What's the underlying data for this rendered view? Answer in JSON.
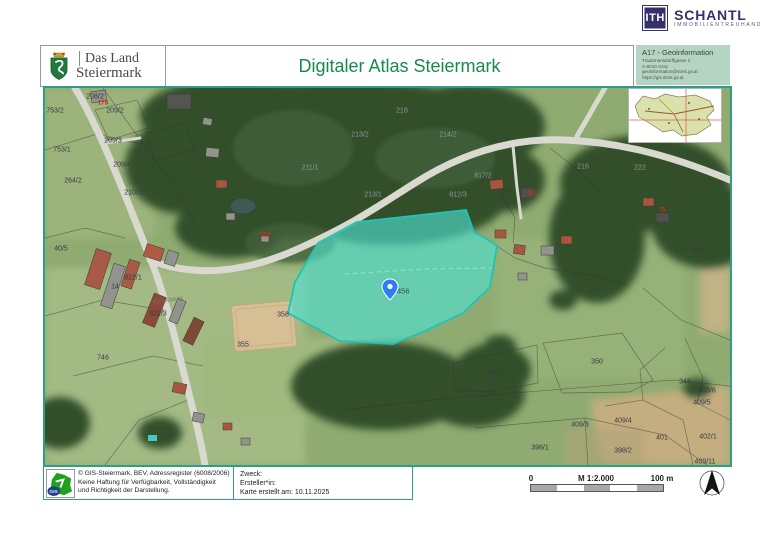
{
  "brand": {
    "abbr": "ITH",
    "name": "SCHANTL",
    "subtitle": "IMMOBILIENTREUHAND"
  },
  "header": {
    "logo": {
      "line1": "Das Land",
      "line2": "Steiermark"
    },
    "title": "Digitaler Atlas Steiermark",
    "info_box": {
      "title": "A17 - Geoinformation",
      "address1": "Trauttmansdorffgasse 2",
      "address2": "A-8010 Graz",
      "email": "geoinformation@stmk.gv.at",
      "url": "https://gis.stmk.gv.at"
    }
  },
  "map": {
    "pin_label": "456",
    "highlight_color": "#35d0c0",
    "labels": [
      {
        "t": "208/2",
        "x": 50,
        "y": 9,
        "c": "p"
      },
      {
        "t": "178",
        "x": 58,
        "y": 15,
        "c": "r"
      },
      {
        "t": "753/2",
        "x": 10,
        "y": 23,
        "c": "p"
      },
      {
        "t": "209/2",
        "x": 70,
        "y": 23,
        "c": "p"
      },
      {
        "t": "209/3",
        "x": 68,
        "y": 53,
        "c": "p"
      },
      {
        "t": "753/1",
        "x": 17,
        "y": 62,
        "c": "p"
      },
      {
        "t": "209/4",
        "x": 77,
        "y": 77,
        "c": "p"
      },
      {
        "t": "264/2",
        "x": 28,
        "y": 93,
        "c": "p"
      },
      {
        "t": "210/2",
        "x": 88,
        "y": 105,
        "c": "p"
      },
      {
        "t": "218",
        "x": 357,
        "y": 23,
        "c": "g"
      },
      {
        "t": "213/2",
        "x": 315,
        "y": 47,
        "c": "g"
      },
      {
        "t": "214/2",
        "x": 403,
        "y": 47,
        "c": "g"
      },
      {
        "t": "211/1",
        "x": 265,
        "y": 80,
        "c": "g"
      },
      {
        "t": "213/1",
        "x": 328,
        "y": 107,
        "c": "g"
      },
      {
        "t": "817/2",
        "x": 438,
        "y": 88,
        "c": "g"
      },
      {
        "t": "812/3",
        "x": 413,
        "y": 107,
        "c": "g"
      },
      {
        "t": "216",
        "x": 538,
        "y": 79,
        "c": "g"
      },
      {
        "t": "222",
        "x": 595,
        "y": 80,
        "c": "g"
      },
      {
        "t": "53",
        "x": 487,
        "y": 105,
        "c": "r"
      },
      {
        "t": "75",
        "x": 617,
        "y": 122,
        "c": "r"
      },
      {
        "t": "16/1",
        "x": 460,
        "y": 104,
        "c": "p"
      },
      {
        "t": "347",
        "x": 652,
        "y": 162,
        "c": "p"
      },
      {
        "t": "162",
        "x": 220,
        "y": 147,
        "c": "r"
      },
      {
        "t": "40/5",
        "x": 16,
        "y": 161,
        "c": "p"
      },
      {
        "t": "822/1",
        "x": 88,
        "y": 190,
        "c": "p"
      },
      {
        "t": "14",
        "x": 70,
        "y": 199,
        "c": "p"
      },
      {
        "t": "Streitberg",
        "x": 123,
        "y": 213,
        "c": "road",
        "rot": -10
      },
      {
        "t": "822/3",
        "x": 113,
        "y": 226,
        "c": "p"
      },
      {
        "t": "358",
        "x": 238,
        "y": 227,
        "c": "p"
      },
      {
        "t": "355",
        "x": 198,
        "y": 257,
        "c": "p"
      },
      {
        "t": "746",
        "x": 58,
        "y": 270,
        "c": "p"
      },
      {
        "t": "351",
        "x": 450,
        "y": 285,
        "c": "p"
      },
      {
        "t": "350",
        "x": 552,
        "y": 274,
        "c": "p"
      },
      {
        "t": "348",
        "x": 640,
        "y": 294,
        "c": "p"
      },
      {
        "t": "409/6",
        "x": 662,
        "y": 303,
        "c": "p"
      },
      {
        "t": "409/5",
        "x": 657,
        "y": 315,
        "c": "p"
      },
      {
        "t": "409/3",
        "x": 535,
        "y": 337,
        "c": "p"
      },
      {
        "t": "409/4",
        "x": 578,
        "y": 333,
        "c": "p"
      },
      {
        "t": "401",
        "x": 617,
        "y": 350,
        "c": "p"
      },
      {
        "t": "402/1",
        "x": 663,
        "y": 349,
        "c": "p"
      },
      {
        "t": "398/1",
        "x": 495,
        "y": 360,
        "c": "p"
      },
      {
        "t": "398/2",
        "x": 578,
        "y": 363,
        "c": "p"
      },
      {
        "t": "409/11",
        "x": 660,
        "y": 374,
        "c": "p"
      }
    ]
  },
  "footer": {
    "copyright_line1": "© GIS-Steiermark, BEV, Adressregister (6008/2006)",
    "copyright_line2": "Keine Haftung für Verfügbarkeit, Vollständigkeit",
    "copyright_line3": "und Richtigkeit der Darstellung.",
    "zweck_label": "Zweck:",
    "ersteller_label": "Ersteller*in:",
    "created_label": "Karte erstellt am: 10.11.2025",
    "gis_logo_text": "GIS"
  },
  "scalebar": {
    "zero": "0",
    "scale": "M 1:2.000",
    "max": "100 m"
  }
}
